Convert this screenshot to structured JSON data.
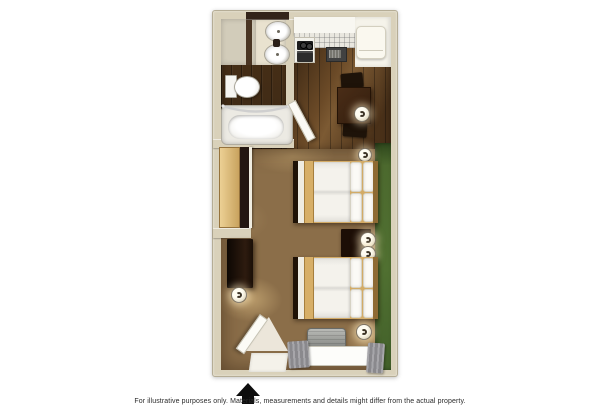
{
  "disclaimer": "For illustrative purposes only.  Materials, measurements and details might differ from the actual property.",
  "plan": {
    "type": "studio-suite-floor-plan",
    "entrance_indicator": "black up-arrow at entry door",
    "rooms": [
      "bathroom",
      "kitchen",
      "dining area",
      "sleeping area",
      "closet",
      "entry"
    ],
    "fixtures": [
      "vanity-with-two-sinks",
      "toilet",
      "bathtub-with-shower-rod",
      "kitchen-counter-with-tile",
      "stove-cooktop",
      "oven",
      "microwave",
      "refrigerator",
      "dining-table",
      "two-dining-chairs",
      "table-lamp",
      "sliding-door-closet",
      "dresser",
      "dresser-lamp",
      "double-bed-1",
      "double-bed-2",
      "nightstand",
      "two-nightstand-lamps",
      "wall-sconce-upper",
      "wall-sconce-lower",
      "air-conditioner",
      "window-with-gray-curtains",
      "entry-door",
      "bathroom-door",
      "green-accent-carpet"
    ]
  },
  "colors": {
    "background": "#ffffff",
    "wall": "#d9d1ba",
    "bathroom_wood": "#422c16",
    "kitchen_wood": "#5f4023",
    "carpet": "#8b6e49",
    "green_carpet": "#4c692e",
    "closet_door": "#d9b26e",
    "counter_white": "#f5f3ea",
    "dark_furniture": "#2a1810",
    "bedding": "#f4f2ec",
    "bed_frame_tan": "#d3ab66",
    "curtain_gray": "#98979b",
    "arrow": "#0d0d0d",
    "text": "#2b2b2b"
  }
}
